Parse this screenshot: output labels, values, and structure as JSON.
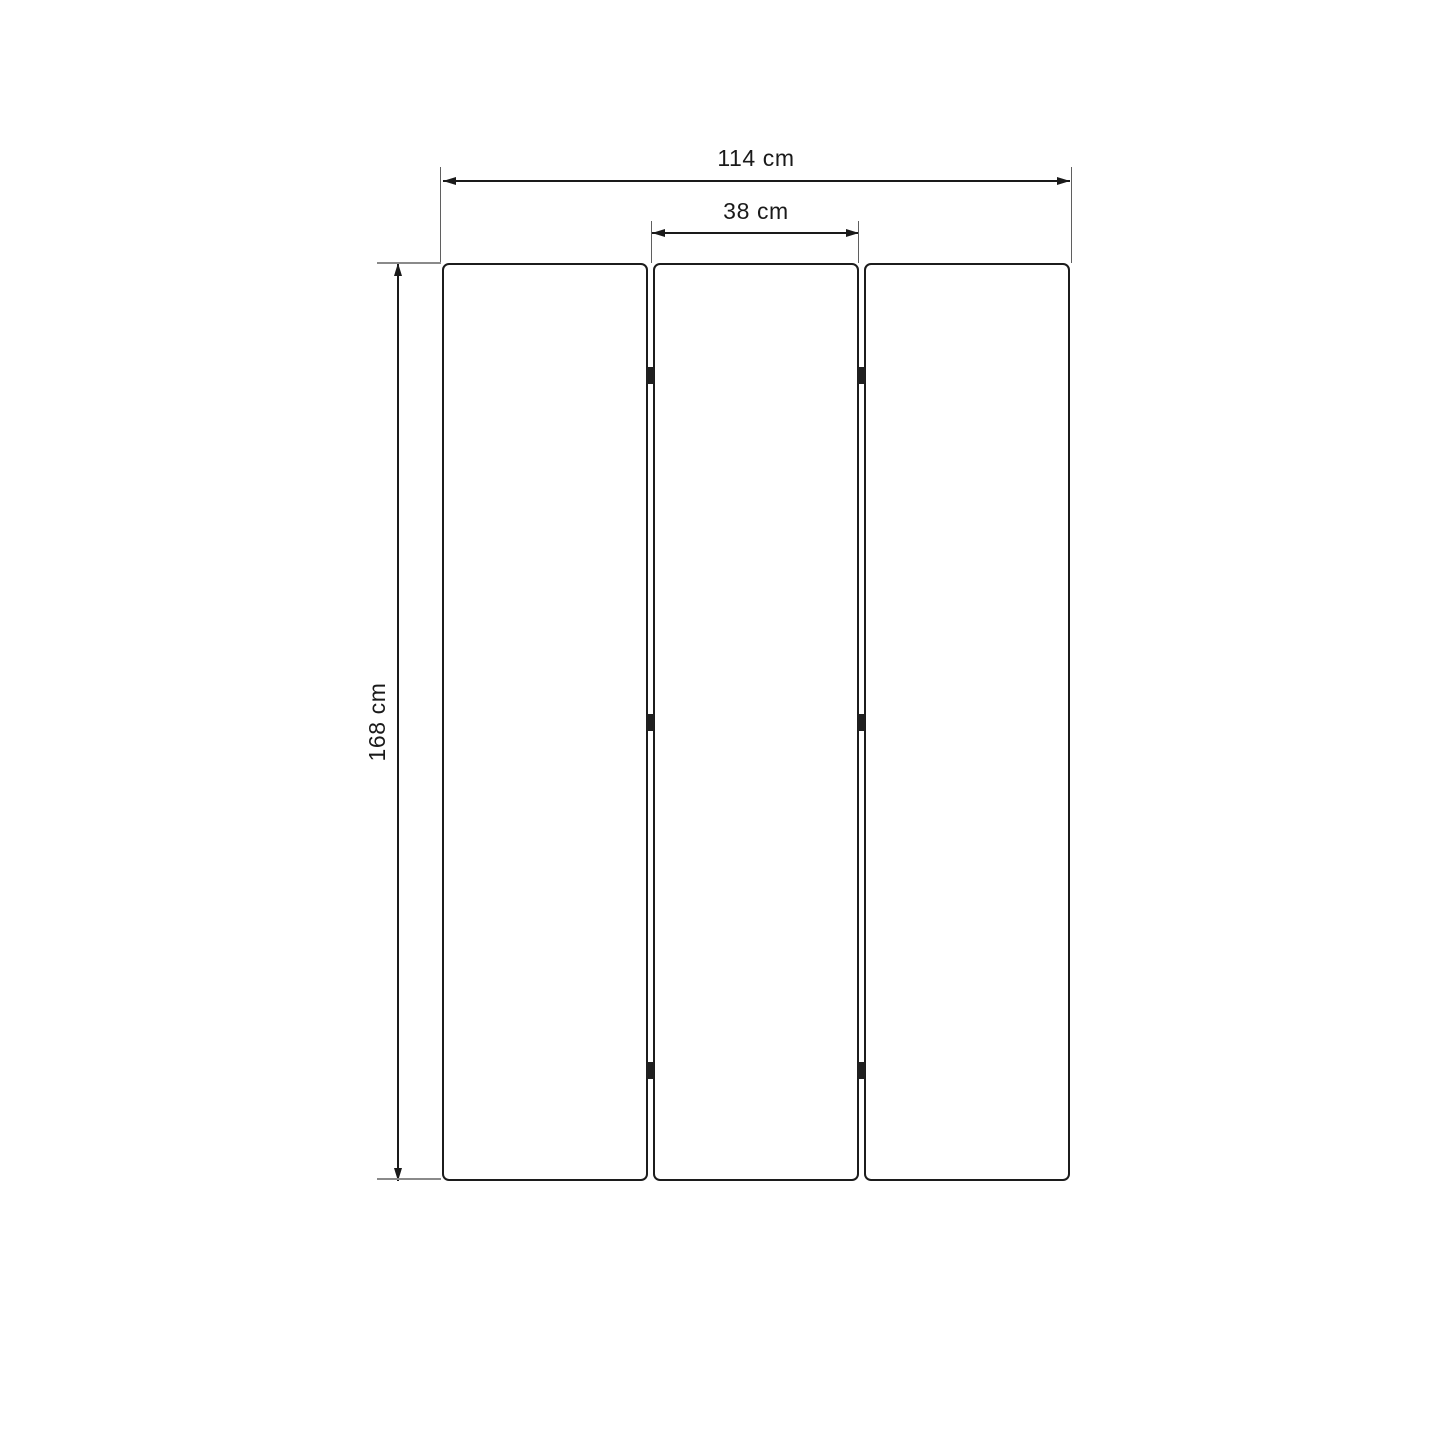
{
  "diagram": {
    "type": "furniture-dimension-drawing",
    "background_color": "#ffffff",
    "line_color": "#1a1a1a",
    "extension_line_color": "#8a8a8a",
    "panels": {
      "count": 3,
      "hinge_rows": 3
    },
    "dimensions": {
      "total_width": {
        "label": "114 cm"
      },
      "panel_width": {
        "label": "38 cm"
      },
      "height": {
        "label": "168 cm"
      }
    }
  }
}
